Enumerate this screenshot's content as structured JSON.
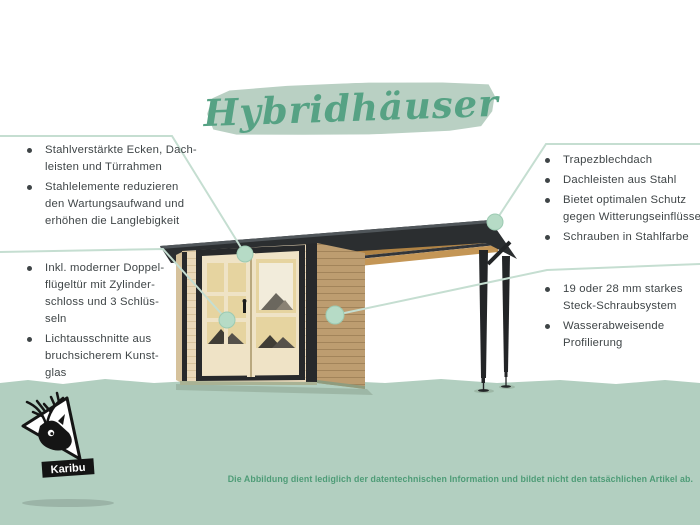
{
  "title": "Hybridhäuser",
  "callouts": {
    "top_left": {
      "items": [
        "Stahlverstärkte Ecken, Dach-\nleisten und Türrahmen",
        "Stahlelemente reduzieren\nden Wartungsaufwand und\nerhöhen die Langlebigkeit"
      ]
    },
    "bottom_left": {
      "items": [
        "Inkl. moderner Doppel-\nflügeltür mit Zylinder-\nschloss und 3 Schlüs-\nseln",
        "Lichtausschnitte aus\nbruchsicherem Kunst-\nglas"
      ]
    },
    "top_right": {
      "items": [
        "Trapezblechdach",
        "Dachleisten aus Stahl",
        "Bietet optimalen Schutz\ngegen Witterungseinflüsse",
        "Schrauben in Stahlfarbe"
      ]
    },
    "bottom_right": {
      "items": [
        "19 oder 28 mm starkes\nSteck-Schraubsystem",
        "Wasserabweisende\nProfilierung"
      ]
    }
  },
  "logo": {
    "brand": "Karibu"
  },
  "disclaimer": "Die Abbildung dient lediglich der datentechnischen Information und bildet nicht den tatsächlichen Artikel ab.",
  "colors": {
    "accent_green": "#56a284",
    "brush_green": "#b9d0c3",
    "band_green": "#b2cfc0",
    "callout_line": "#c5ded1",
    "callout_dot": "#b6dbc6",
    "text_dark": "#3f4547",
    "roof_black": "#2b2e30",
    "wood_front": "#ead9ba",
    "wood_side": "#bd9d70",
    "disclaimer_green": "#4e9c77"
  }
}
